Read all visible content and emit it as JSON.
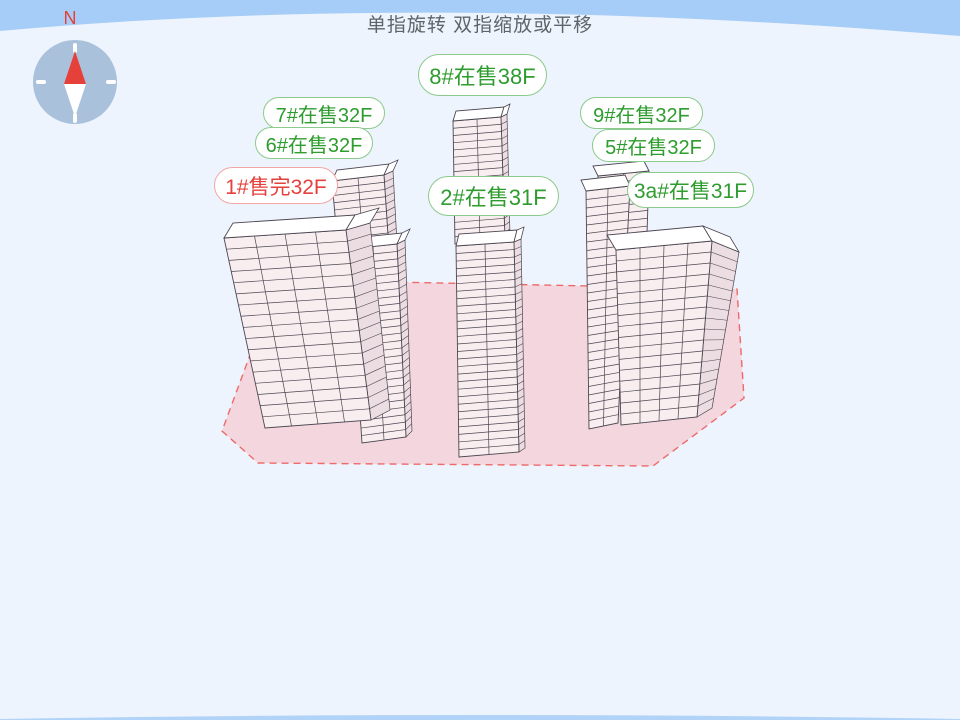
{
  "header": {
    "hint": "单指旋转 双指缩放或平移"
  },
  "compass": {
    "north_label": "N"
  },
  "buildings": [
    {
      "id": "7#",
      "status": "在售",
      "floors": "32F",
      "label": "7#在售32F",
      "state": "selling"
    },
    {
      "id": "6#",
      "status": "在售",
      "floors": "32F",
      "label": "6#在售32F",
      "state": "selling"
    },
    {
      "id": "1#",
      "status": "售完",
      "floors": "32F",
      "label": "1#售完32F",
      "state": "sold-out"
    },
    {
      "id": "8#",
      "status": "在售",
      "floors": "38F",
      "label": "8#在售38F",
      "state": "selling"
    },
    {
      "id": "2#",
      "status": "在售",
      "floors": "31F",
      "label": "2#在售31F",
      "state": "selling"
    },
    {
      "id": "9#",
      "status": "在售",
      "floors": "32F",
      "label": "9#在售32F",
      "state": "selling"
    },
    {
      "id": "5#",
      "status": "在售",
      "floors": "32F",
      "label": "5#在售32F",
      "state": "selling"
    },
    {
      "id": "3a#",
      "status": "在售",
      "floors": "31F",
      "label": "3a#在售31F",
      "state": "selling"
    }
  ],
  "colors": {
    "sky_band": "#a6cdf7",
    "background": "#eef4fd",
    "ground_fill": "#f4d1d8",
    "ground_border": "#ed6a6a",
    "label_selling": "#2e9c2e",
    "label_sold_out": "#e5403c",
    "compass_disc": "#a4bcd9",
    "compass_north_needle": "#e6403a"
  }
}
